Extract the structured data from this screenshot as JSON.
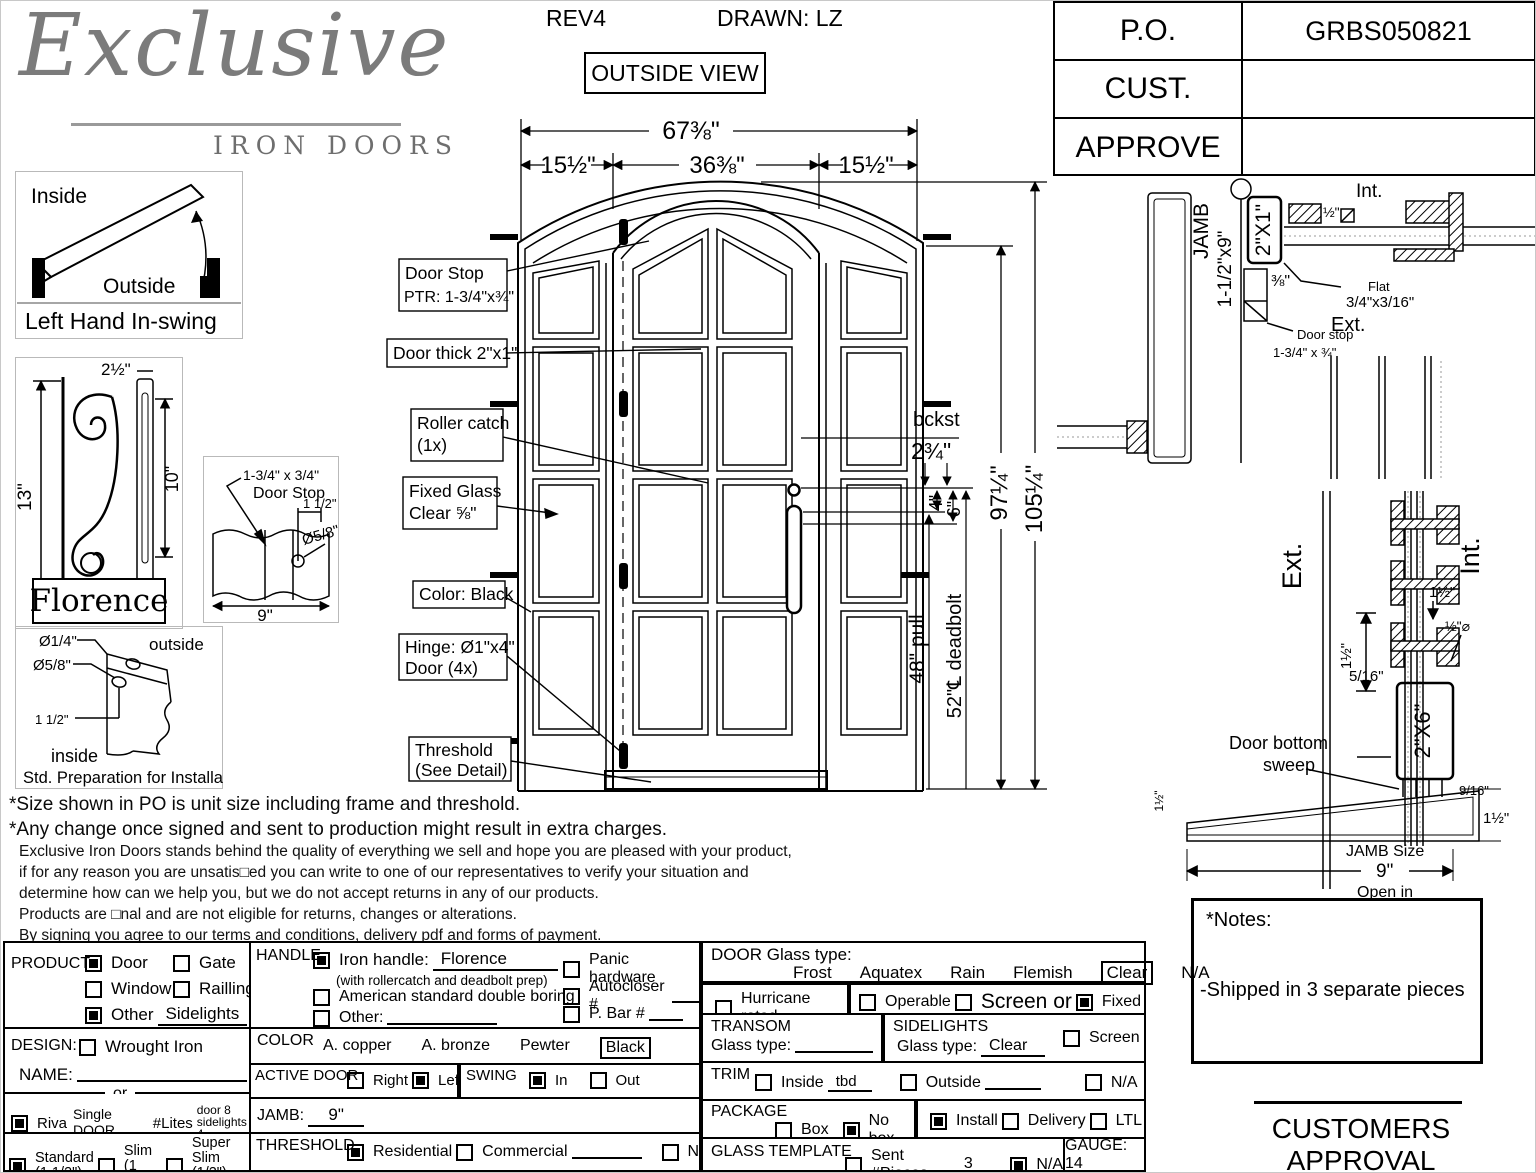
{
  "header": {
    "logo_script": "Exclusive",
    "logo_sub": "IRON DOORS",
    "rev": "REV4",
    "drawn": "DRAWN: LZ",
    "view": "OUTSIDE VIEW",
    "po_label": "P.O.",
    "po_value": "GRBS050821",
    "cust_label": "CUST.",
    "cust_value": "",
    "approve_label": "APPROVE",
    "approve_value": ""
  },
  "swing": {
    "inside": "Inside",
    "outside": "Outside",
    "caption": "Left Hand In-swing"
  },
  "florence": {
    "h": "13\"",
    "top": "2½\"",
    "inner": "10\"",
    "name": "Florence"
  },
  "doorstop": {
    "l1": "1-3/4\" x 3/4\"",
    "l2": "Door Stop",
    "d1": "1 1/2\"",
    "d2": "Ø5/8\"",
    "d3": "9\""
  },
  "prep": {
    "d1": "Ø1/4\"",
    "d2": "Ø5/8\"",
    "d3": "1 1/2\"",
    "outside": "outside",
    "inside": "inside",
    "caption": "Std. Preparation for Installation"
  },
  "elevation": {
    "dim_overall": "67⅜\"",
    "dim_left": "15½\"",
    "dim_center": "36⅜\"",
    "dim_right": "15½\"",
    "dim_h1": "97¼\"",
    "dim_h2": "105¼\"",
    "bckst1": "bckst",
    "bckst2": "2¾\"",
    "dim4": "4\"",
    "dim6": "6\"",
    "pull": "48\" pull",
    "deadbolt": "52\"℄ deadbolt",
    "labels": {
      "door_stop1": "Door Stop",
      "door_stop2": "PTR: 1-3/4\"x¾\"",
      "door_thick": "Door thick 2\"x1\"",
      "roller1": "Roller catch",
      "roller2": "(1x)",
      "glass1": "Fixed Glass",
      "glass2": "Clear ⅝\"",
      "color": "Color: Black",
      "hinge1": "Hinge: Ø1\"x4\"",
      "hinge2": "Door (4x)",
      "threshold1": "Threshold",
      "threshold2": "(See Detail)"
    }
  },
  "plan_detail": {
    "jamb": "JAMB",
    "jamb_size": "1-1/2\"x9\"",
    "tube": "2\"X1\"",
    "int": "Int.",
    "ext": "Ext.",
    "half": "½\"",
    "flat1": "Flat",
    "flat2": "3/4\"x3/16\"",
    "threeeighth": "⅜\"",
    "stop1": "Door stop",
    "stop2": "1-3/4\" x ¾\""
  },
  "section_detail": {
    "ext": "Ext.",
    "int": "Int.",
    "d1": "1½\"",
    "d2": "1½\"",
    "d3": "½\"⌀",
    "d4": "5/16\"",
    "tube": "2\"X6\"",
    "sweep1": "Door bottom",
    "sweep2": "sweep",
    "d5": "9/16\"",
    "d6": "1½\"",
    "d7": "1½\"",
    "jamb_size_label": "JAMB Size",
    "jamb_size_val": "9\"",
    "open_in": "Open in"
  },
  "notes": {
    "line1": "*Size shown in PO is unit size including frame and threshold.",
    "line2": "*Any change once signed and sent to production might result in extra charges.",
    "p1": "Exclusive Iron Doors stands behind the quality of everything we sell and hope you are pleased with your product,",
    "p2": "if for any reason you are unsatis□ed you can write to one of our representatives to verify your situation and",
    "p3": "determine how can we help you, but we do not accept returns in any of our products.",
    "p4": "Products are □nal and are not eligible for returns, changes or alterations.",
    "p5": "By signing you agree to our terms and conditions, delivery pdf and forms of payment.",
    "p6": "*Doors measurements do not include the gaps between jambs"
  },
  "form": {
    "product": {
      "label": "PRODUCT:",
      "door": "Door",
      "gate": "Gate",
      "window": "Window",
      "railing": "Railling",
      "other": "Other",
      "other_value": "Sidelights"
    },
    "handle": {
      "label": "HANDLE",
      "iron": "Iron handle:",
      "iron_value": "Florence",
      "iron_sub": "(with rollercatch and deadbolt prep)",
      "american": "American standard double boring",
      "other": "Other:",
      "panic": "Panic hardware",
      "autocloser": "Autocloser #",
      "pbar": "P. Bar #"
    },
    "glass": {
      "label": "DOOR Glass type:",
      "frost": "Frost",
      "aquatex": "Aquatex",
      "rain": "Rain",
      "flemish": "Flemish",
      "clear": "Clear",
      "na": "N/A",
      "hurricane": "Hurricane rated",
      "operable": "Operable",
      "screen_or": "Screen or",
      "fixed": "Fixed"
    },
    "design": {
      "label": "DESIGN:",
      "wrought": "Wrought Iron",
      "name_label": "NAME:",
      "or": "or",
      "riva": "Riva",
      "riva_value": "Single DOOR",
      "lites": "#Lites",
      "lites_v1": "door 8",
      "lites_v2": "sidelights 4",
      "standard": "Standard",
      "standard_sub": "(1 1/2\")",
      "slim": "Slim",
      "slim_sub": "(1 1/4\")",
      "superslim": "Super Slim",
      "superslim_sub": "(1/2\") SDL"
    },
    "color": {
      "label": "COLOR",
      "copper": "A. copper",
      "bronze": "A. bronze",
      "pewter": "Pewter",
      "black": "Black"
    },
    "active": {
      "label": "ACTIVE DOOR",
      "right": "Right",
      "left": "Left"
    },
    "swing": {
      "label": "SWING",
      "in": "In",
      "out": "Out"
    },
    "jamb": {
      "label": "JAMB:",
      "value": "9\""
    },
    "threshold": {
      "label": "THRESHOLD",
      "residential": "Residential",
      "commercial": "Commercial",
      "na": "N/A"
    },
    "transom": {
      "label": "TRANSOM",
      "glass_label": "Glass type:"
    },
    "sidelights": {
      "label": "SIDELIGHTS",
      "glass_label": "Glass type:",
      "value": "Clear",
      "screen": "Screen"
    },
    "trim": {
      "label": "TRIM",
      "inside": "Inside",
      "inside_value": "tbd",
      "outside": "Outside",
      "na": "N/A"
    },
    "package": {
      "label": "PACKAGE",
      "box": "Box",
      "nobox": "No box",
      "install": "Install",
      "delivery": "Delivery",
      "ltl": "LTL"
    },
    "template": {
      "label": "GLASS TEMPLATE",
      "sent": "Sent #Pieces",
      "pieces": "3",
      "na": "N/A"
    },
    "gauge": "GAUGE: 14",
    "checks": {
      "product_door": true,
      "product_gate": false,
      "product_window": false,
      "product_railing": false,
      "product_other": true,
      "handle_iron": true,
      "handle_american": false,
      "handle_other": false,
      "panic": false,
      "autocloser": false,
      "pbar": false,
      "hurricane": false,
      "operable": false,
      "screen": false,
      "fixed": true,
      "wrought": false,
      "riva": true,
      "standard": true,
      "slim": false,
      "superslim": false,
      "active_right": false,
      "active_left": true,
      "swing_in": true,
      "swing_out": false,
      "threshold_residential": true,
      "threshold_commercial": false,
      "threshold_na": false,
      "sidelights_screen": false,
      "trim_inside": false,
      "trim_outside": false,
      "trim_na": false,
      "package_box": false,
      "package_nobox": true,
      "package_install": true,
      "package_delivery": false,
      "package_ltl": false,
      "template_sent": false,
      "template_na": true
    }
  },
  "notes_box": {
    "title": "*Notes:",
    "body": "-Shipped in 3 separate pieces"
  },
  "approval": "CUSTOMERS APPROVAL",
  "colors": {
    "ink": "#000000",
    "logo_gray": "#7b7b7b",
    "paper": "#ffffff"
  }
}
